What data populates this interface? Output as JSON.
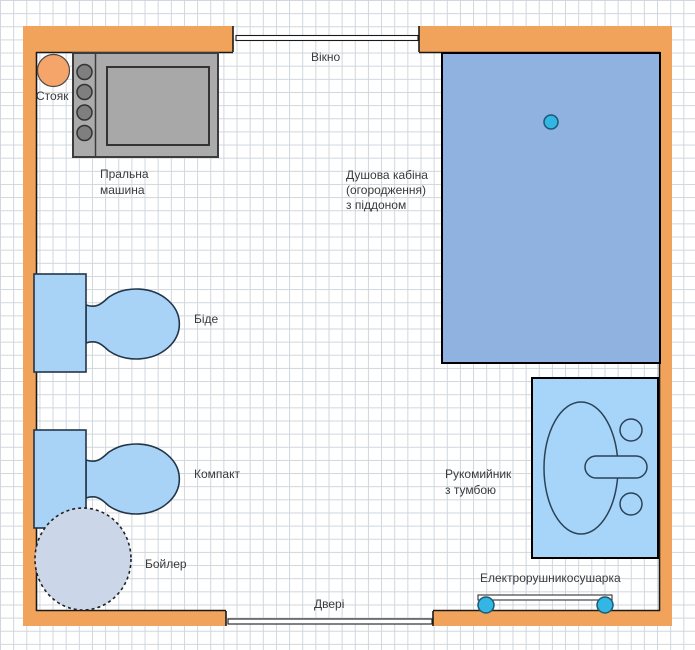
{
  "labels": {
    "riser": "Стояк",
    "washing_machine": "Пральна\nмашина",
    "window": "Вікно",
    "shower": "Душова кабіна\n(огородження)\nз піддоном",
    "bidet": "Біде",
    "toilet": "Компакт",
    "boiler": "Бойлер",
    "washbasin": "Рукомийник\nз тумбою",
    "towel_dryer": "Електрорушникосушарка",
    "door": "Двері"
  },
  "colors": {
    "wall": "#F2A35B",
    "fixture_blue": "#A9D3F6",
    "shower_blue": "#8FB2E0",
    "washbasin_blue": "#A7D5F9",
    "boiler_fill": "#CBD7E9",
    "machine_body": "#ABABAB",
    "machine_drum": "#A8A8A8",
    "knob_gray": "#7F7F7F",
    "riser_orange": "#F5A569",
    "cyan_point": "#33B6E3",
    "grid": "#CFD6DD",
    "opening_white": "#FFFFFF"
  }
}
